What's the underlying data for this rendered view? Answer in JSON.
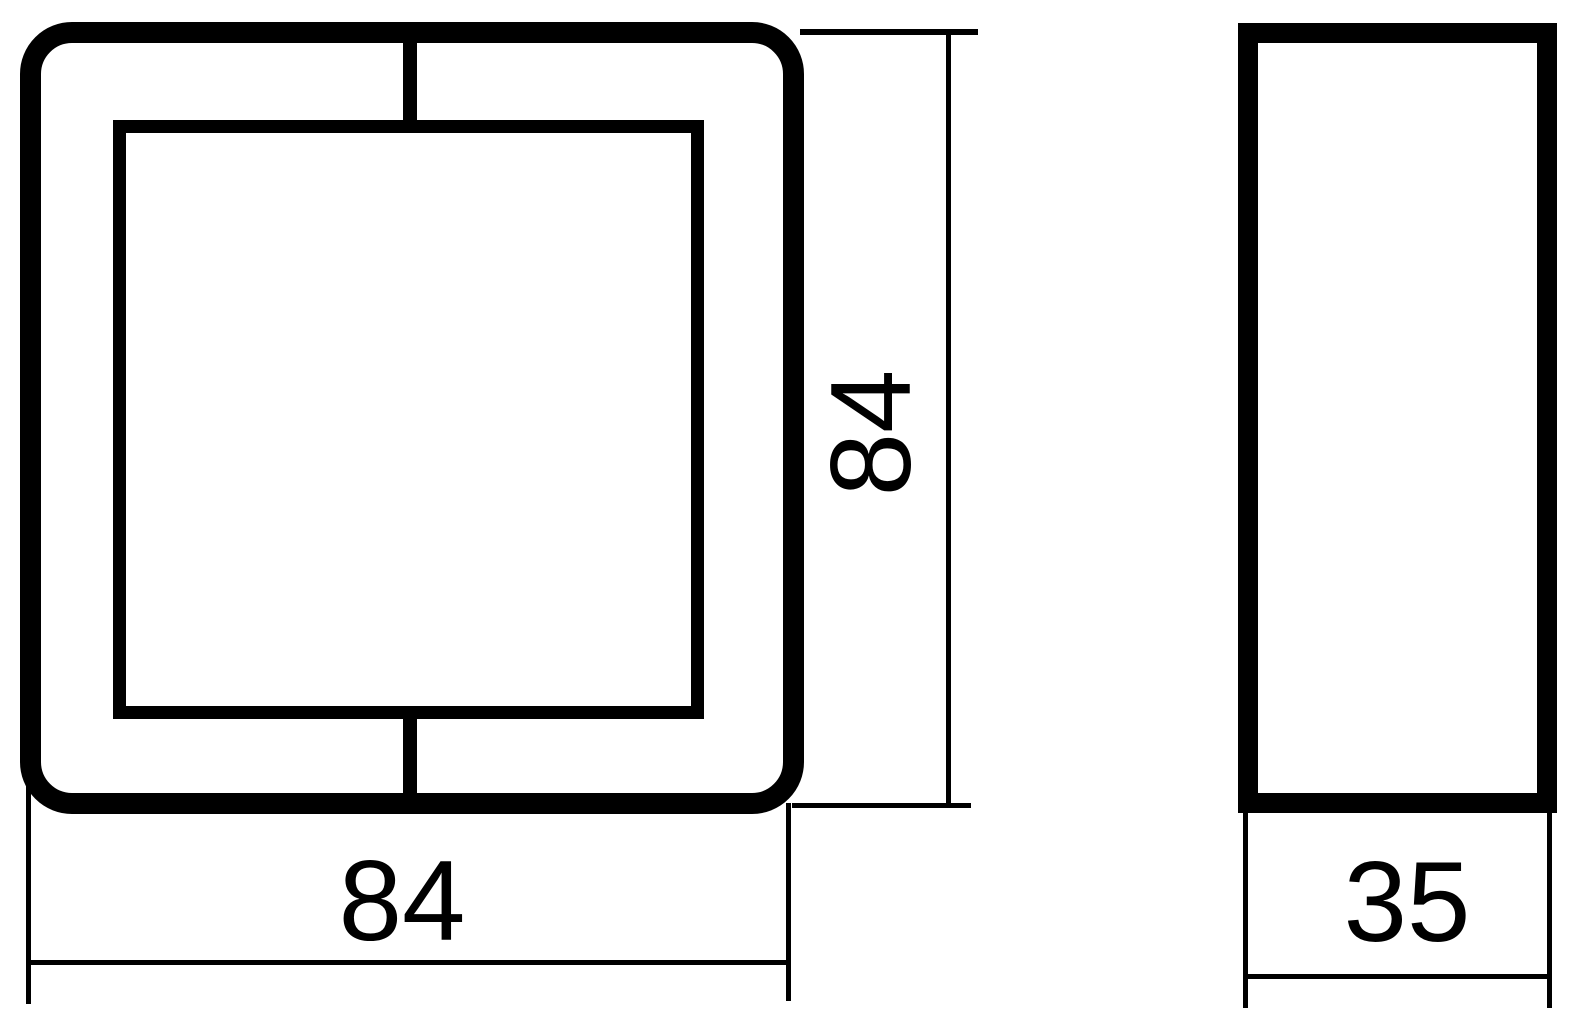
{
  "colors": {
    "line": "#000000",
    "background": "#ffffff"
  },
  "dimensions": {
    "front_height": {
      "value": 84,
      "label": "84",
      "orientation": "vertical"
    },
    "front_width": {
      "value": 84,
      "label": "84",
      "orientation": "horizontal"
    },
    "side_depth": {
      "value": 35,
      "label": "35",
      "orientation": "horizontal"
    }
  }
}
